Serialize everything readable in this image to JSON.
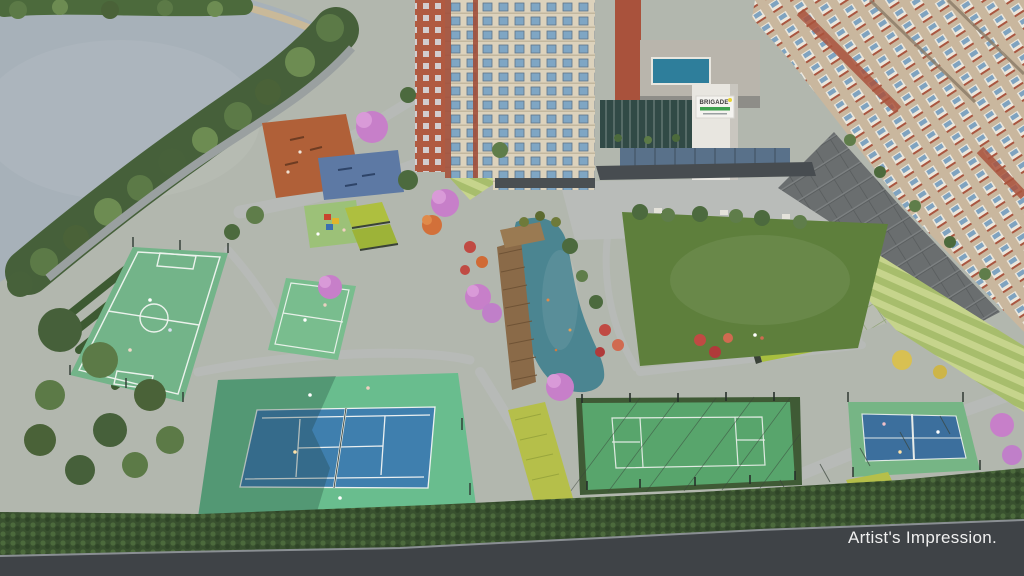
{
  "image": {
    "caption": "Artist's Impression."
  },
  "signage": {
    "brand": "BRIGADE",
    "accent_bar_color": "#3da14e",
    "logo_dot_color": "#e8d433"
  },
  "palette": {
    "lake_water": "#a7b1b9",
    "pond_water": "#4b8591",
    "rooftop_pool": "#2e7e9b",
    "lawn_green": "#5e7f3c",
    "football_court": "#73b489",
    "multi_court": "#79bd8e",
    "tennis_surround": "#69bd8e",
    "tennis_blue": "#3f7fae",
    "caged_court_green": "#58a56c",
    "small_court_surround": "#76b585",
    "small_court_blue": "#3c6f9d",
    "fitness_pad_blue": "#5d79a4",
    "kids_pad_green": "#9cc178",
    "outdoor_gym_terracotta": "#b06038",
    "pavilion_roof_lime": "#a8bf3f",
    "building_cream": "#dcd2bc",
    "building_terracotta": "#b05a41",
    "flower_pink": "#c77fc9",
    "flower_red": "#c04a43",
    "road_dark": "#3f4347",
    "path_gray": "#b7bab7",
    "hedge_dark_green": "#39512f"
  }
}
